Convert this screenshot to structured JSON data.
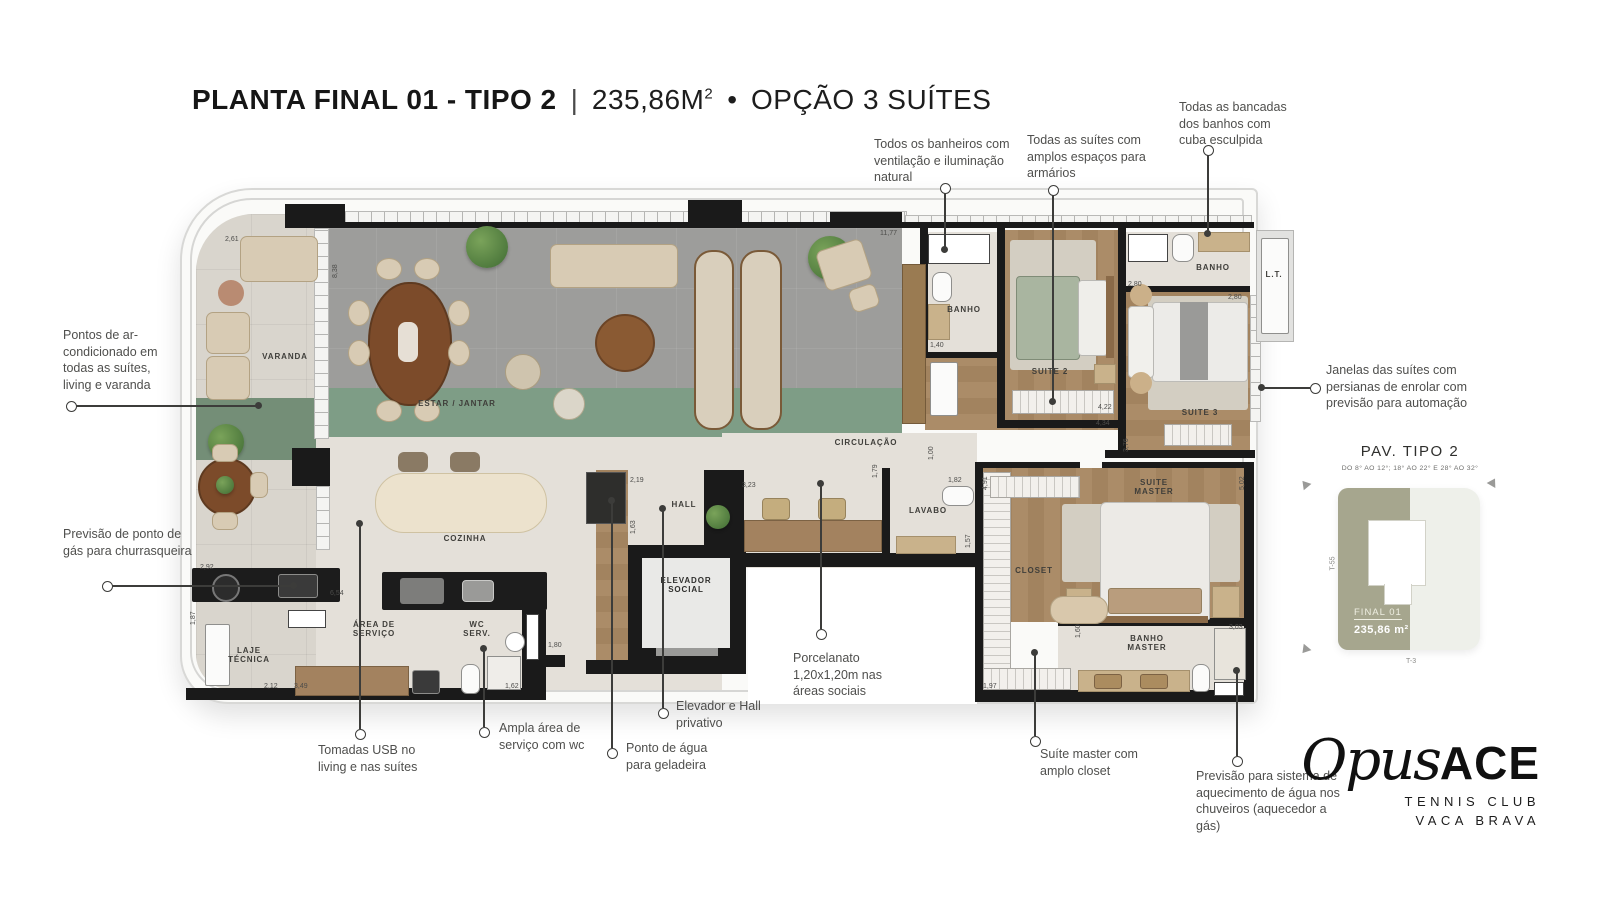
{
  "title": {
    "main": "PLANTA FINAL 01 - TIPO 2",
    "sep": "|",
    "area": "235,86M",
    "area_sup": "2",
    "dot": "•",
    "option": "OPÇÃO 3 SUÍTES"
  },
  "annotations": {
    "ac": "Pontos de ar-condicionado em todas as suítes, living e varanda",
    "gas": "Previsão de ponto de gás para churrasqueira",
    "banheiros": "Todos os banheiros com ventilação e iluminação natural",
    "suites_armarios": "Todas as suítes com amplos espaços para armários",
    "bancadas": "Todas as bancadas dos banhos com cuba esculpida",
    "janelas": "Janelas das suítes com persianas de enrolar com previsão para automação",
    "usb": "Tomadas USB no living e nas suítes",
    "servico_wc": "Ampla área de serviço com wc",
    "agua_geladeira": "Ponto de água para geladeira",
    "elevador_hall": "Elevador e Hall privativo",
    "suite_master_closet": "Suíte master com amplo closet",
    "aquecimento": "Previsão para sistema de aquecimento de água nos chuveiros (aquecedor a gás)",
    "porcelanato": "Porcelanato 1,20x1,20m nas áreas sociais"
  },
  "plan": {
    "rooms": {
      "varanda": "VARANDA",
      "estar": "ESTAR / JANTAR",
      "cozinha": "COZINHA",
      "circulacao": "CIRCULAÇÃO",
      "hall": "HALL",
      "elevador": "ELEVADOR SOCIAL",
      "lavabo": "LAVABO",
      "area_servico": "ÁREA DE SERVIÇO",
      "wc_serv": "WC SERV.",
      "laje": "LAJE TÉCNICA",
      "banho2": "BANHO",
      "suite2": "SUITE 2",
      "banho3": "BANHO",
      "lt": "L.T.",
      "suite3": "SUITE 3",
      "suite_master": "SUITE MASTER",
      "closet": "CLOSET",
      "banho_master": "BANHO MASTER"
    },
    "dims": [
      "2,61",
      "8,38",
      "11,77",
      "2,80",
      "1,40",
      "4,22",
      "4,34",
      "2,80",
      "2,19",
      "3,23",
      "1,63",
      "1,00",
      "1,82",
      "1,79",
      "1,57",
      "2,92",
      "6,54",
      "1,87",
      "2,12",
      "3,49",
      "1,80",
      "1,62",
      "4,91",
      "1,97",
      "1,60",
      "3,03",
      "3,76",
      "5,02"
    ]
  },
  "keyplan": {
    "title": "PAV. TIPO 2",
    "subtitle": "DO 8° AO 12°; 18° AO 22° E 28° AO 32°",
    "unit": "FINAL 01",
    "unit_area": "235,86 m²",
    "axis_left": "T-55",
    "axis_bottom": "T-3"
  },
  "logo": {
    "script": "Opus",
    "bold": "ACE",
    "line1": "TENNIS CLUB",
    "line2": "VACA BRAVA"
  },
  "colors": {
    "green_band": "#7e9d86",
    "wood_floor": "#a88a65",
    "concrete_floor": "#9d9d9b",
    "beige_floor": "#e4e0d9",
    "wall": "#1a1a1a",
    "keyplan_olive": "#a6a68e"
  }
}
